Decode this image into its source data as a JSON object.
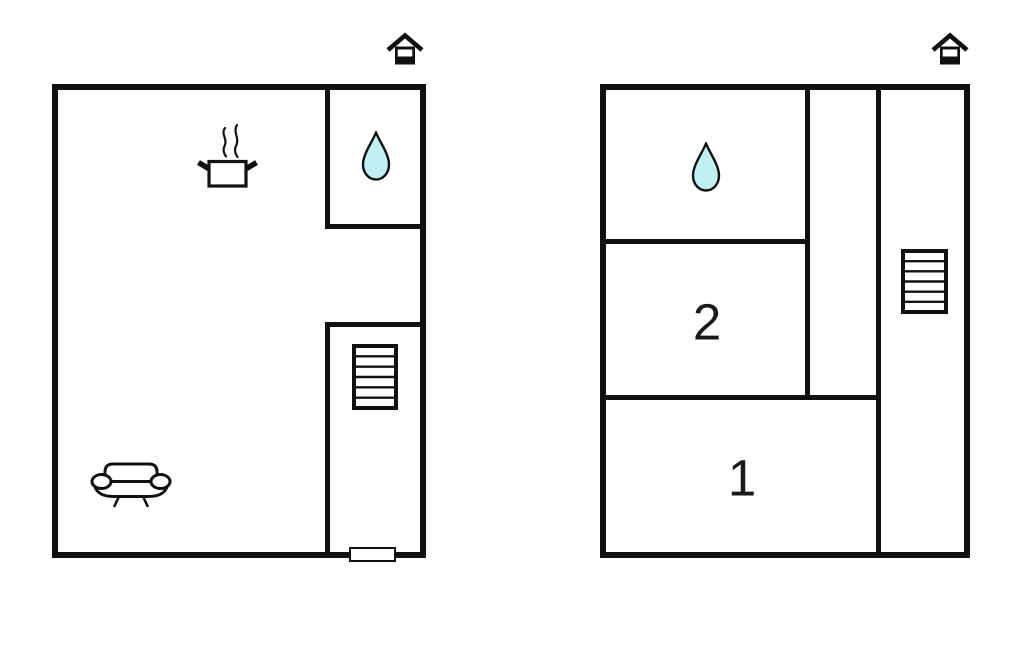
{
  "canvas": {
    "background": "#ffffff",
    "wall_color": "#111111",
    "water_drop_color": "#c0f0f2",
    "label_color": "#1a1a1a"
  },
  "left_plan": {
    "name": "ground-floor-plan",
    "icons": {
      "entrance": "house-icon",
      "kitchen": "cooking-pot-icon",
      "bathroom": "water-drop-icon",
      "stairs": "stairs-icon",
      "living_area": "sofa-icon",
      "entry": "door-opening"
    }
  },
  "right_plan": {
    "name": "upper-floor-plan",
    "icons": {
      "entrance": "house-icon",
      "bathroom": "water-drop-icon",
      "stairs": "stairs-icon"
    },
    "room_labels": [
      {
        "text": "2"
      },
      {
        "text": "1"
      }
    ]
  }
}
